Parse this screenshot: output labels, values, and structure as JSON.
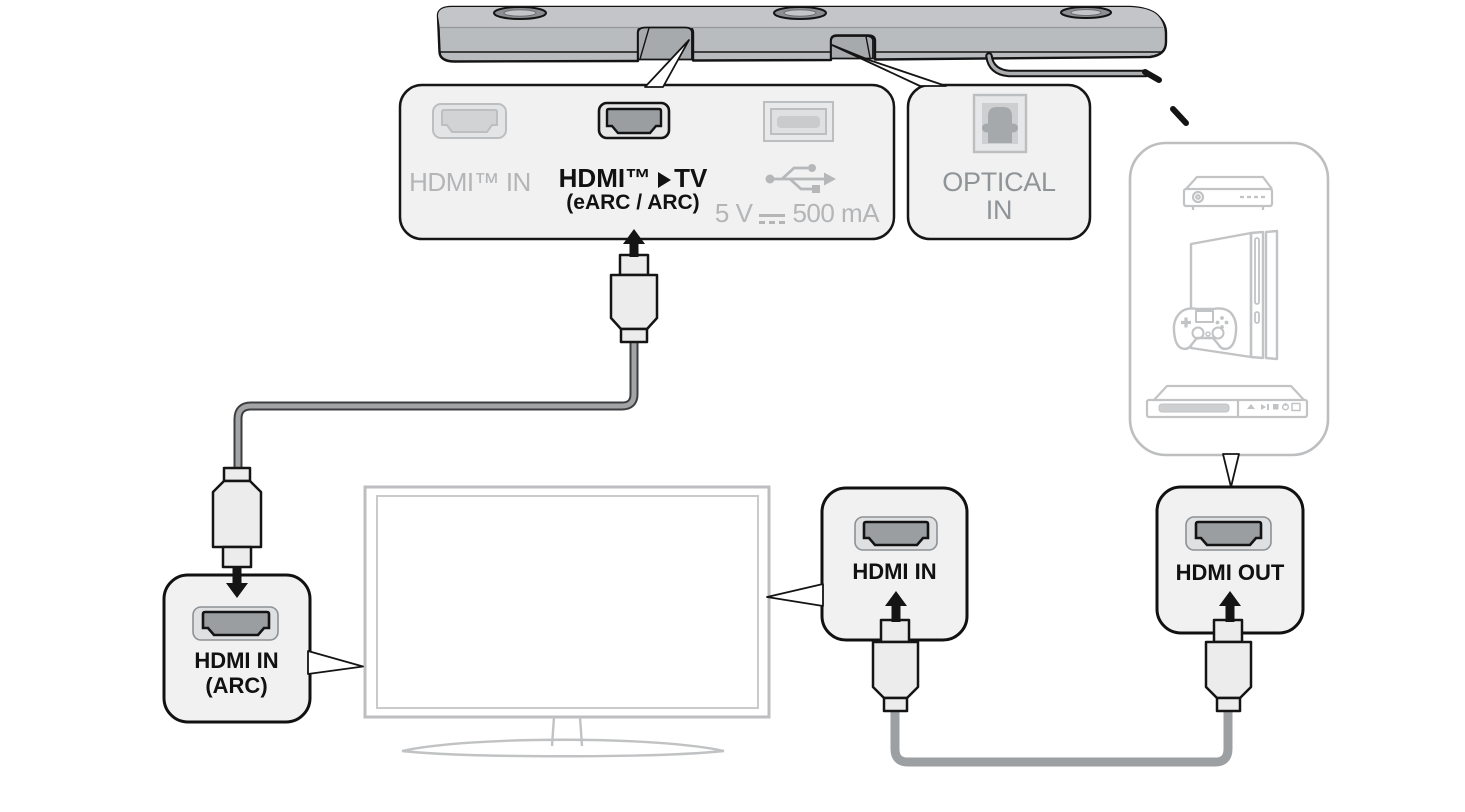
{
  "soundbar_ports_panel": {
    "hdmi_in_label": "HDMI™ IN",
    "hdmi_tv_label_pre": "HDMI™",
    "hdmi_tv_label_post": "TV",
    "hdmi_tv_sublabel": "(eARC / ARC)",
    "usb_power_prefix": "5 V",
    "usb_power_suffix": "500 mA"
  },
  "optical_panel": {
    "label_line1": "OPTICAL",
    "label_line2": "IN"
  },
  "tv_hdmi_arc_panel": {
    "label_line1": "HDMI IN",
    "label_line2": "(ARC)"
  },
  "device_hdmi_in_panel": {
    "label": "HDMI IN"
  },
  "device_hdmi_out_panel": {
    "label": "HDMI OUT"
  },
  "icons": {
    "arrow_right": "solid right triangle between HDMI™ and TV",
    "dc_power": "solid line over dashed line (5V DC symbol)",
    "usb": "USB trident",
    "optical_port": "TOSLINK square port",
    "hdmi_port": "HDMI socket opening",
    "device_box_devices": [
      "set-top-box",
      "game-console",
      "blu-ray-player"
    ]
  },
  "colors": {
    "black_text": "#111111",
    "disabled_gray_text": "#b3b5b6",
    "optical_gray_text": "#8f9497",
    "panel_fill": "#f1f1f2",
    "soundbar_fill": "#b9bcbe",
    "device_outline_gray": "#c1c3c5",
    "cable_gray": "#9da0a2",
    "dark_port_fill": "#9a9ea1"
  }
}
